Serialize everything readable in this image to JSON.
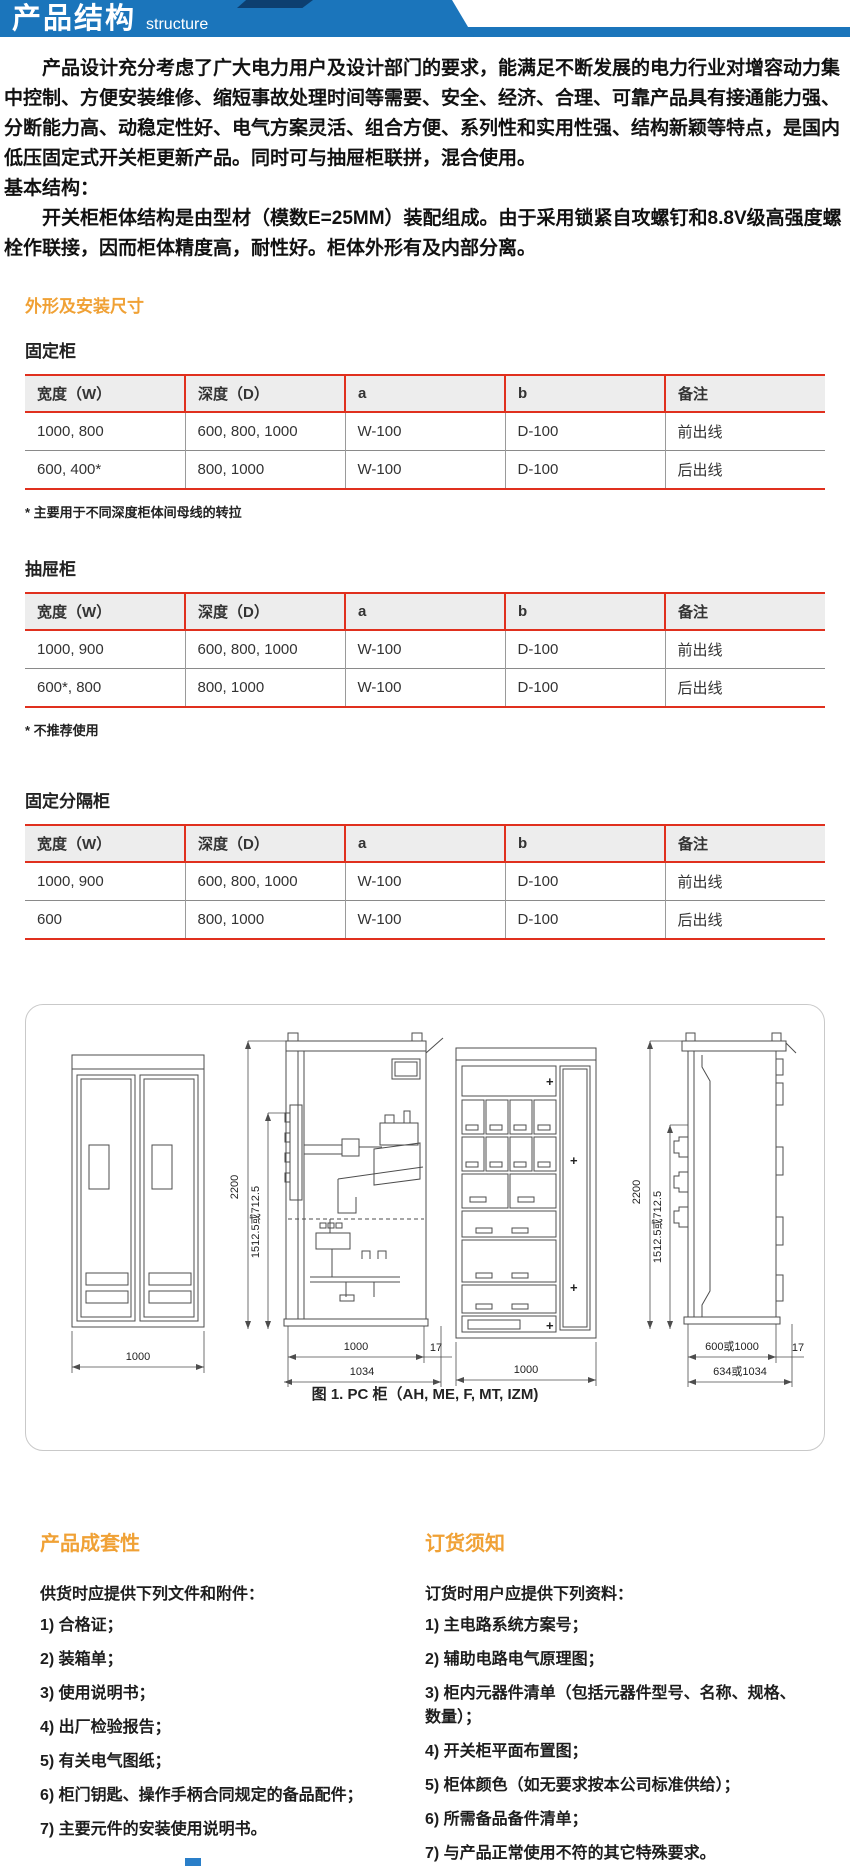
{
  "header": {
    "title": "产品结构",
    "subtitle": "structure",
    "bar_color": "#1b75bb",
    "accent_color": "#0d3f70"
  },
  "intro": {
    "p1": "产品设计充分考虑了广大电力用户及设计部门的要求，能满足不断发展的电力行业对增容动力集中控制、方便安装维修、缩短事故处理时间等需要、安全、经济、合理、可靠产品具有接通能力强、分断能力高、动稳定性好、电气方案灵活、组合方便、系列性和实用性强、结构新颖等特点，是国内低压固定式开关柜更新产品。同时可与抽屉柜联拼，混合使用。",
    "basic_label": "基本结构：",
    "p2": "开关柜柜体结构是由型材（模数E=25MM）装配组成。由于采用锁紧自攻螺钉和8.8V级高强度螺栓作联接，因而柜体精度高，耐性好。柜体外形有及内部分离。"
  },
  "dimensions_section": {
    "heading": "外形及安装尺寸",
    "tables": [
      {
        "title": "固定柜",
        "headers": [
          "宽度（W）",
          "深度（D）",
          "a",
          "b",
          "备注"
        ],
        "rows": [
          [
            "1000, 800",
            "600, 800, 1000",
            "W-100",
            "D-100",
            "前出线"
          ],
          [
            "600, 400*",
            "800, 1000",
            "W-100",
            "D-100",
            "后出线"
          ]
        ],
        "footnote": "* 主要用于不同深度柜体间母线的转拉"
      },
      {
        "title": "抽屉柜",
        "headers": [
          "宽度（W）",
          "深度（D）",
          "a",
          "b",
          "备注"
        ],
        "rows": [
          [
            "1000, 900",
            "600, 800, 1000",
            "W-100",
            "D-100",
            "前出线"
          ],
          [
            "600*, 800",
            "800, 1000",
            "W-100",
            "D-100",
            "后出线"
          ]
        ],
        "footnote": "* 不推荐使用"
      },
      {
        "title": "固定分隔柜",
        "headers": [
          "宽度（W）",
          "深度（D）",
          "a",
          "b",
          "备注"
        ],
        "rows": [
          [
            "1000, 900",
            "600, 800, 1000",
            "W-100",
            "D-100",
            "前出线"
          ],
          [
            "600",
            "800, 1000",
            "W-100",
            "D-100",
            "后出线"
          ]
        ],
        "footnote": ""
      }
    ]
  },
  "figure": {
    "caption": "图 1. PC 柜（AH, ME, F, MT, IZM)",
    "plus_mark": "+",
    "dims": {
      "height_total": "2200",
      "height_partial": "1512.5或712.5",
      "width_front": "1000",
      "width_side_inner": "1000",
      "width_side_outer": "1034",
      "overhang": "17",
      "width_side2_inner": "600或1000",
      "width_side2_outer": "634或1034"
    }
  },
  "bottom": {
    "left": {
      "heading": "产品成套性",
      "intro": "供货时应提供下列文件和附件：",
      "items": [
        "1) 合格证；",
        "2) 装箱单；",
        "3) 使用说明书；",
        "4) 出厂检验报告；",
        "5) 有关电气图纸；",
        "6) 柜门钥匙、操作手柄合同规定的备品配件；",
        "7) 主要元件的安装使用说明书。"
      ]
    },
    "right": {
      "heading": "订货须知",
      "intro": "订货时用户应提供下列资料：",
      "items": [
        "1) 主电路系统方案号；",
        "2) 辅助电路电气原理图；",
        "3) 柜内元器件清单（包括元器件型号、名称、规格、数量）；",
        "4) 开关柜平面布置图；",
        "5) 柜体颜色（如无要求按本公司标准供给）；",
        "6) 所需备品备件清单；",
        "7) 与产品正常使用不符的其它特殊要求。"
      ]
    }
  }
}
